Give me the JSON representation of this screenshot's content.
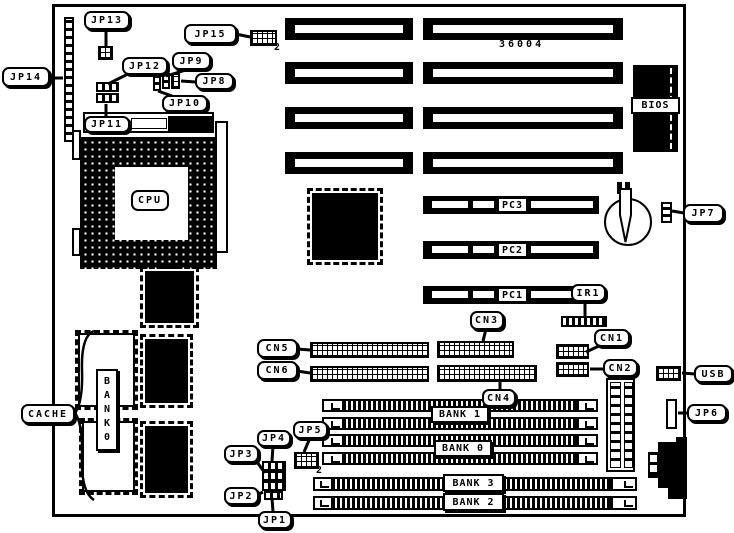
{
  "labels": {
    "jp1": "JP1",
    "jp2": "JP2",
    "jp3": "JP3",
    "jp4": "JP4",
    "jp5": "JP5",
    "jp6": "JP6",
    "jp7": "JP7",
    "jp8": "JP8",
    "jp9": "JP9",
    "jp10": "JP10",
    "jp11": "JP11",
    "jp12": "JP12",
    "jp13": "JP13",
    "jp14": "JP14",
    "jp15": "JP15",
    "cn1": "CN1",
    "cn2": "CN2",
    "cn3": "CN3",
    "cn4": "CN4",
    "cn5": "CN5",
    "cn6": "CN6",
    "ir1": "IR1",
    "usb": "USB",
    "cpu": "CPU",
    "bios": "BIOS",
    "cache": "CACHE",
    "pc1": "PC1",
    "pc2": "PC2",
    "pc3": "PC3",
    "bank0_simm": "BANK 0",
    "bank1_simm": "BANK 1",
    "bank2_simm": "BANK 2",
    "bank3_simm": "BANK 3",
    "cache_bank_vertical": "B\nA\nN\nK\n0",
    "board_number": "36004",
    "pin2_jp15": "2",
    "pin2_jp5": "2"
  }
}
